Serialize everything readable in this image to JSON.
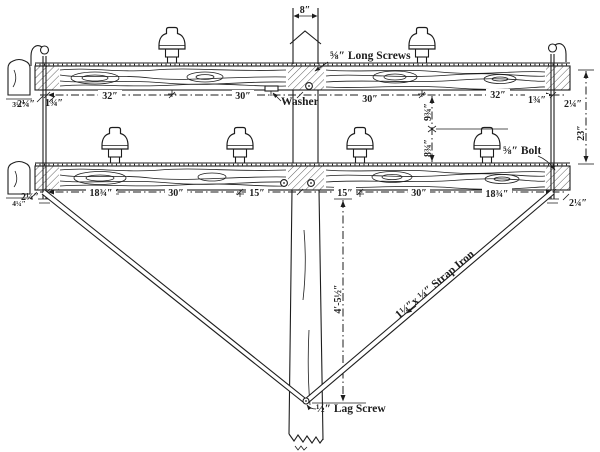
{
  "palette": {
    "paper": "#ffffff",
    "ink": "#1d1d1d"
  },
  "labels": {
    "pole_width": "8″",
    "long_screws": "⅝″ Long Screws",
    "washer": "Washer",
    "bolt": "⅝″ Bolt",
    "lag_screw": "½″ Lag Screw",
    "strap_iron": "1¼″x ¼″ Strap Iron"
  },
  "dims": {
    "top_arm": [
      "2¼″",
      "1¾″",
      "32″",
      "30″",
      "30″",
      "32″",
      "1¾″",
      "2¼″"
    ],
    "bottom_arm": [
      "2¼″",
      "18¾″",
      "30″",
      "15″",
      "15″",
      "30″",
      "18¾″",
      "2¼″"
    ],
    "between_arms_upper": "9¾″",
    "between_arms_lower": "8¾″",
    "arms_overall": "23″",
    "brace_drop": "4′-5½″",
    "arm_section_top": "3¼″",
    "arm_section_bottom": "4¼″"
  }
}
